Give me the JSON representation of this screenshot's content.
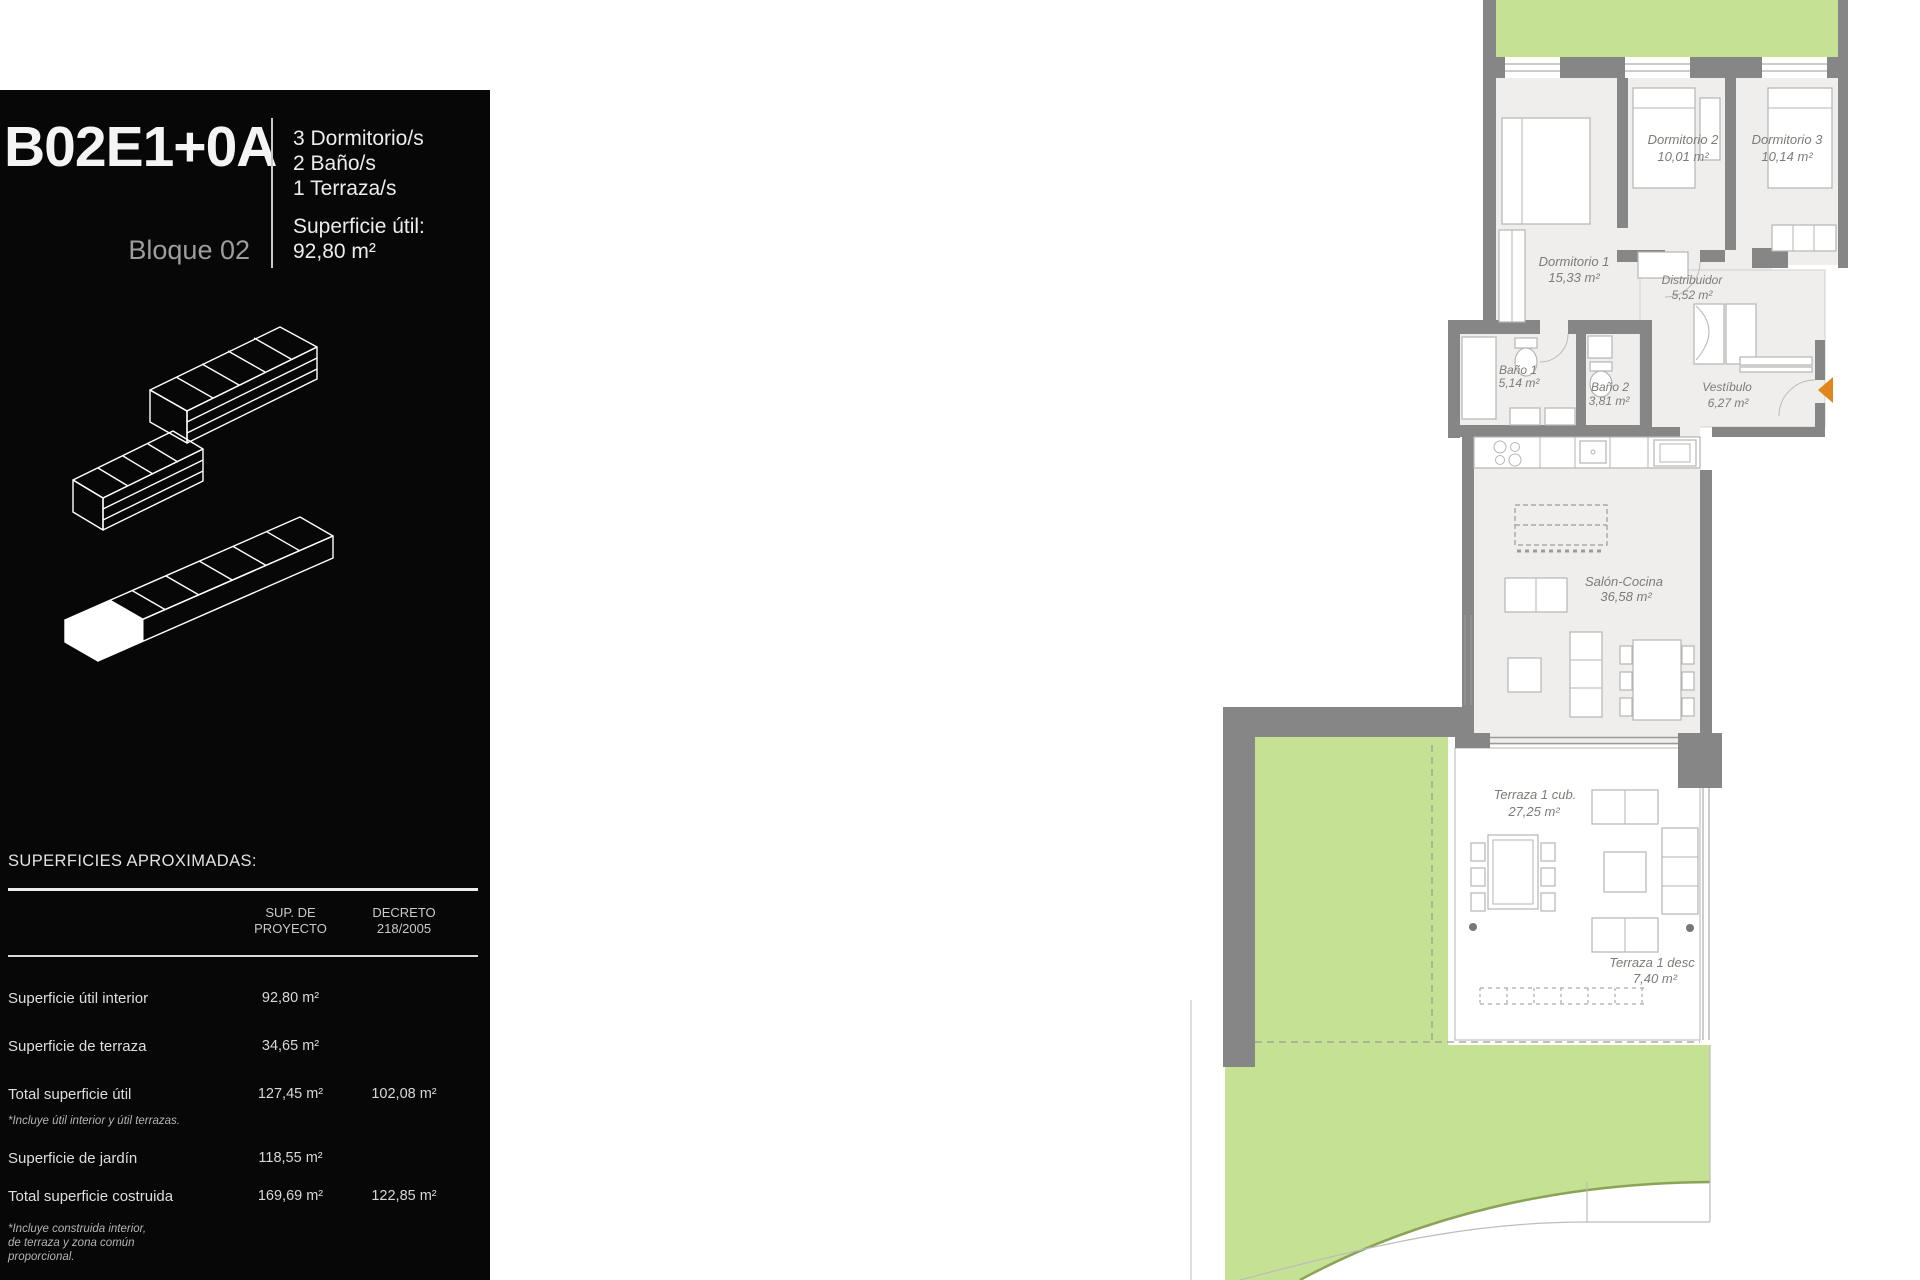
{
  "panel": {
    "unit_code": "B02E1+0A",
    "block_label": "Bloque 02",
    "features": {
      "f1": "3 Dormitorio/s",
      "f2": "2 Baño/s",
      "f3": "1 Terraza/s"
    },
    "surface_label": "Superficie útil:",
    "surface_value": "92,80 m²",
    "table": {
      "title": "SUPERFICIES APROXIMADAS:",
      "col_proyecto": "SUP. DE\nPROYECTO",
      "col_decreto": "DECRETO\n218/2005",
      "rows": [
        {
          "label": "Superficie útil interior",
          "proyecto": "92,80 m²",
          "decreto": "",
          "note": ""
        },
        {
          "label": "Superficie de terraza",
          "proyecto": "34,65 m²",
          "decreto": "",
          "note": ""
        },
        {
          "label": "Total superficie útil",
          "proyecto": "127,45 m²",
          "decreto": "102,08 m²",
          "note": "*Incluye útil interior y útil terrazas."
        },
        {
          "label": "Superficie de jardín",
          "proyecto": "118,55 m²",
          "decreto": "",
          "note": ""
        },
        {
          "label": "Total superficie costruida",
          "proyecto": "169,69 m²",
          "decreto": "122,85 m²",
          "note": "*Incluye construida interior,\nde terraza y zona común\nproporcional."
        }
      ]
    }
  },
  "plan": {
    "rooms": {
      "dormitorio1": {
        "name": "Dormitorio 1",
        "area": "15,33 m²"
      },
      "dormitorio2": {
        "name": "Dormitorio 2",
        "area": "10,01 m²"
      },
      "dormitorio3": {
        "name": "Dormitorio 3",
        "area": "10,14 m²"
      },
      "distribuidor": {
        "name": "Distribuidor",
        "area": "5,52 m²"
      },
      "bano1": {
        "name": "Baño 1",
        "area": "5,14 m²"
      },
      "bano2": {
        "name": "Baño 2",
        "area": "3,81 m²"
      },
      "vestibulo": {
        "name": "Vestíbulo",
        "area": "6,27 m²"
      },
      "salon": {
        "name": "Salón-Cocina",
        "area": "36,58 m²"
      },
      "terraza_cub": {
        "name": "Terraza 1 cub.",
        "area": "27,25 m²"
      },
      "terraza_desc": {
        "name": "Terraza 1 desc",
        "area": "7,40 m²"
      }
    },
    "colors": {
      "garden_green": "#c5e193",
      "wall_gray": "#868686",
      "room_fill": "#efeeec",
      "entry_arrow_orange": "#e0861a"
    }
  }
}
